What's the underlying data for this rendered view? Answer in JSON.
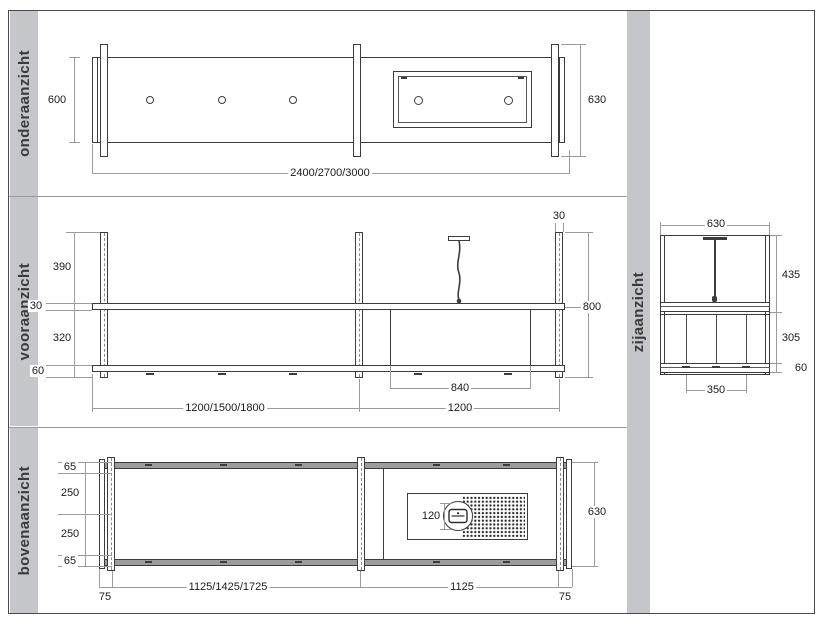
{
  "colors": {
    "drawing_line": "#3c3c3c",
    "dimension_line": "#9b9b9b",
    "label_strip": "#c5c6c9",
    "dimension_text": "#1b1b1b"
  },
  "panels": {
    "onderaanzicht": {
      "label": "onderaanzicht",
      "dim_left": "600",
      "dim_right": "630",
      "dim_bottom": "2400/2700/3000"
    },
    "vooraanzicht": {
      "label": "vooraanzicht",
      "dims_left": [
        "390",
        "30",
        "320",
        "60"
      ],
      "dim_post_top": "30",
      "dim_right": "800",
      "dim_box": "840",
      "dim_bottom_left": "1200/1500/1800",
      "dim_bottom_right": "1200"
    },
    "bovenaanzicht": {
      "label": "bovenaanzicht",
      "dims_left": [
        "65",
        "250",
        "250",
        "65"
      ],
      "dim_offset_left": "75",
      "dim_bottom_left": "1125/1425/1725",
      "dim_bottom_right": "1125",
      "dim_offset_right": "75",
      "dim_socket": "120",
      "dim_right": "630"
    },
    "zijaanzicht": {
      "label": "zijaanzicht",
      "dim_top": "630",
      "dims_right": [
        "435",
        "305",
        "60"
      ],
      "dim_bottom": "350"
    }
  }
}
